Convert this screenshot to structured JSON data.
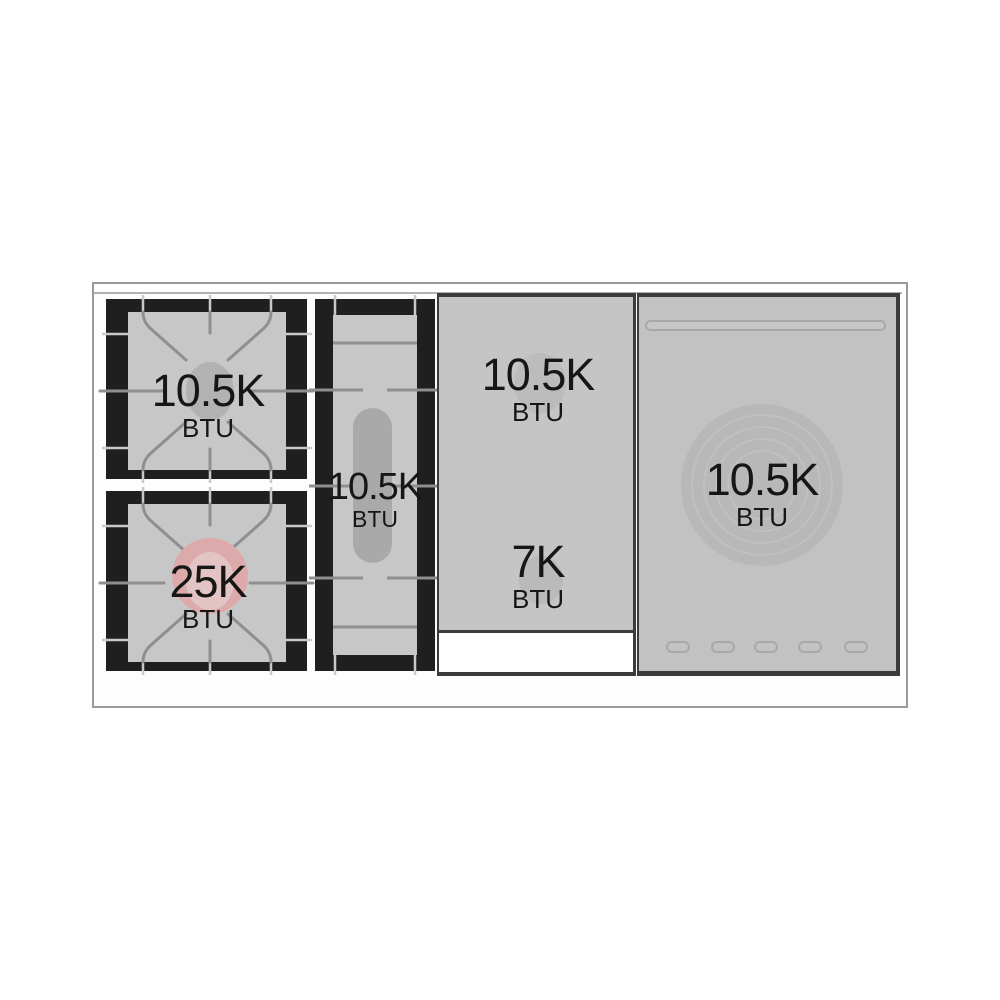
{
  "palette": {
    "background": "#ffffff",
    "frame_border": "#9a9a9c",
    "grate_black": "#1f1f1f",
    "surface_gray": "#c7c7c7",
    "panel_gray": "#c3c3c3",
    "grate_line_gray": "#8f8f8f",
    "burner_oval_gray": "#b2b2b2",
    "accent_pink": "#dcaaaa",
    "dark_panel_border": "#3c3c3c",
    "label_text": "#161616"
  },
  "labels": {
    "burner_top_left": {
      "power": "10.5K",
      "unit": "BTU"
    },
    "burner_bottom_left": {
      "power": "25K",
      "unit": "BTU"
    },
    "burner_center": {
      "power": "10.5K",
      "unit": "BTU"
    },
    "griddle_back": {
      "power": "10.5K",
      "unit": "BTU"
    },
    "griddle_front": {
      "power": "7K",
      "unit": "BTU"
    },
    "french_top": {
      "power": "10.5K",
      "unit": "BTU"
    }
  }
}
